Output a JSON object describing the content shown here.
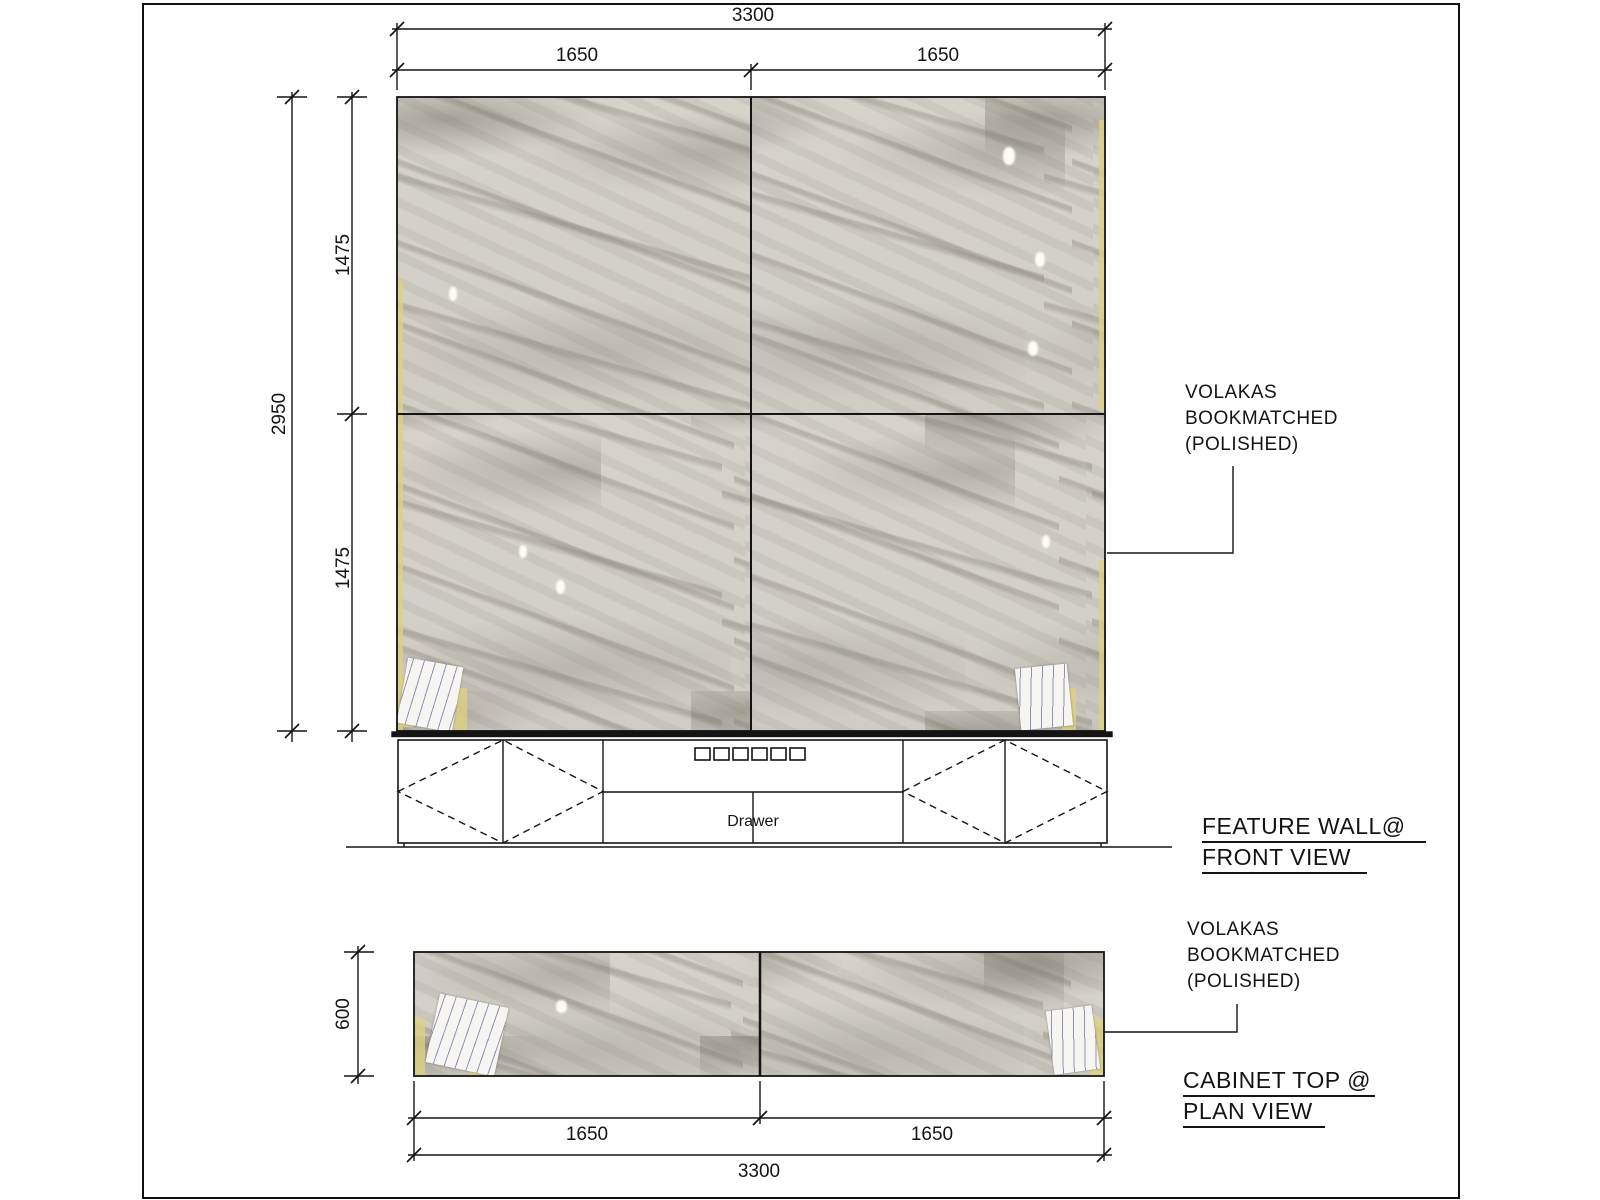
{
  "front_view": {
    "titles": [
      "FEATURE WALL@",
      "FRONT VIEW"
    ],
    "material_label": [
      "VOLAKAS",
      "BOOKMATCHED",
      "(POLISHED)"
    ],
    "dims": {
      "overall_width": "3300",
      "left_panel_width": "1650",
      "right_panel_width": "1650",
      "overall_height": "2950",
      "top_panel_height": "1475",
      "bottom_panel_height": "1475"
    },
    "cabinet": {
      "drawer_label": "Drawer"
    }
  },
  "plan_view": {
    "titles": [
      "CABINET TOP @",
      "PLAN VIEW"
    ],
    "material_label": [
      "VOLAKAS",
      "BOOKMATCHED",
      "(POLISHED)"
    ],
    "dims": {
      "depth": "600",
      "left_panel_width": "1650",
      "right_panel_width": "1650",
      "overall_width": "3300"
    }
  },
  "colors": {
    "line": "#141414",
    "marble_base": "#d3d0c8",
    "marble_vein": "#8a8679",
    "tape": "#ddd27f",
    "paper": "#f6f5f1"
  }
}
